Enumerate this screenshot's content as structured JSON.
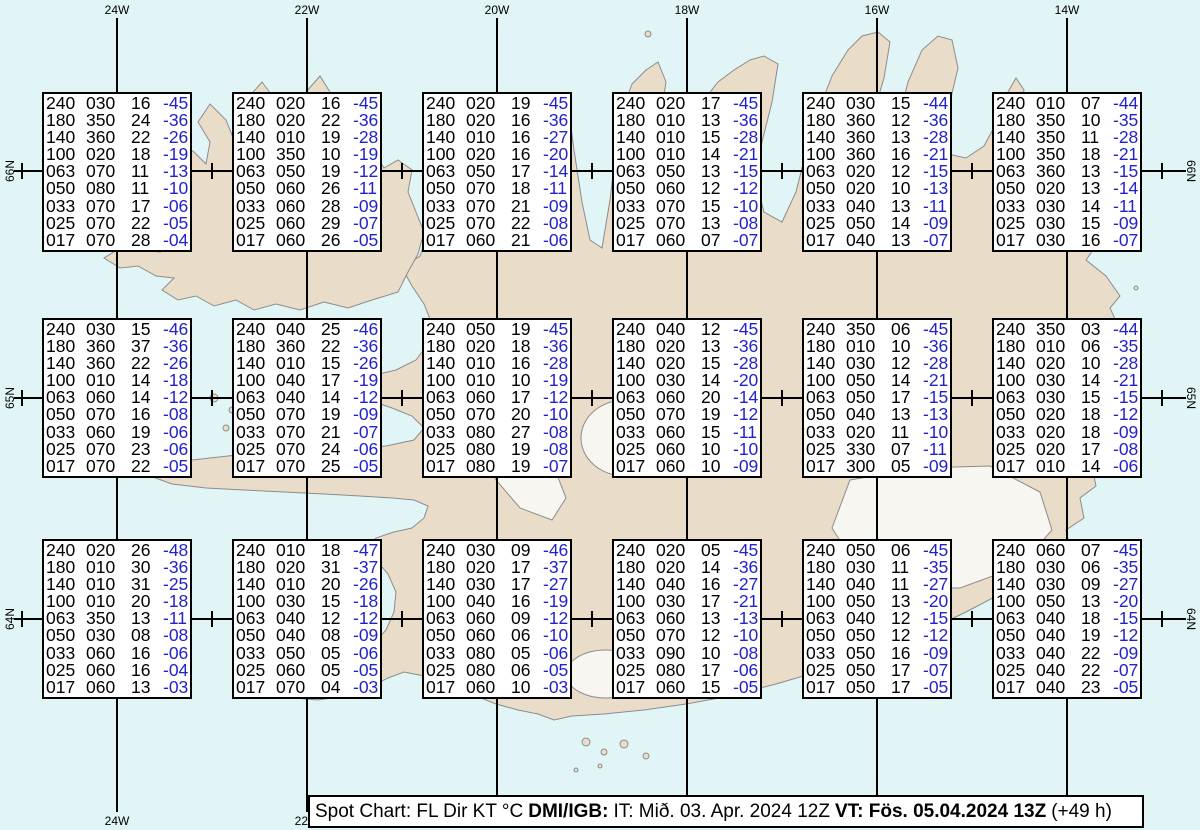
{
  "colors": {
    "ocean": "#E1F5F7",
    "land": "#E9DCC9",
    "glacier": "#F8F6F0",
    "coastline": "#8C8C8C",
    "grid_line": "#000000",
    "box_background": "#FFFFFF",
    "data_text": "#000000",
    "temperature_text": "#2222CC"
  },
  "map": {
    "top_longitude_labels": [
      "24W",
      "22W",
      "20W",
      "18W",
      "16W",
      "14W"
    ],
    "bottom_longitude_labels": [
      "24W",
      "22W"
    ],
    "left_latitude_labels": [
      "66N",
      "65N",
      "64N"
    ],
    "right_latitude_labels": [
      "66N",
      "65N",
      "64N"
    ]
  },
  "caption": {
    "title": "Spot Chart: FL Dir KT °C",
    "source": "DMI/IGB:",
    "issued": "IT: Mið. 03. Apr. 2024 12Z",
    "valid": "VT: Fös. 05.04.2024 13Z",
    "lead": "(+49 h)"
  },
  "chart_data": {
    "type": "table",
    "title": "Spot Chart: FL Dir KT °C",
    "columns": [
      "FL",
      "Dir",
      "KT",
      "°C"
    ],
    "stations": [
      {
        "lat": "66N",
        "lon": "24W",
        "values": [
          [
            "240",
            "030",
            "16",
            "-45"
          ],
          [
            "180",
            "350",
            "24",
            "-36"
          ],
          [
            "140",
            "360",
            "22",
            "-26"
          ],
          [
            "100",
            "020",
            "18",
            "-19"
          ],
          [
            "063",
            "070",
            "11",
            "-13"
          ],
          [
            "050",
            "080",
            "11",
            "-10"
          ],
          [
            "033",
            "070",
            "17",
            "-06"
          ],
          [
            "025",
            "070",
            "22",
            "-05"
          ],
          [
            "017",
            "070",
            "28",
            "-04"
          ]
        ]
      },
      {
        "lat": "66N",
        "lon": "22W",
        "values": [
          [
            "240",
            "020",
            "16",
            "-45"
          ],
          [
            "180",
            "020",
            "22",
            "-36"
          ],
          [
            "140",
            "010",
            "19",
            "-28"
          ],
          [
            "100",
            "350",
            "10",
            "-19"
          ],
          [
            "063",
            "050",
            "19",
            "-12"
          ],
          [
            "050",
            "060",
            "26",
            "-11"
          ],
          [
            "033",
            "060",
            "28",
            "-09"
          ],
          [
            "025",
            "060",
            "29",
            "-07"
          ],
          [
            "017",
            "060",
            "26",
            "-05"
          ]
        ]
      },
      {
        "lat": "66N",
        "lon": "20W",
        "values": [
          [
            "240",
            "020",
            "19",
            "-45"
          ],
          [
            "180",
            "020",
            "16",
            "-36"
          ],
          [
            "140",
            "010",
            "16",
            "-27"
          ],
          [
            "100",
            "020",
            "16",
            "-20"
          ],
          [
            "063",
            "050",
            "17",
            "-14"
          ],
          [
            "050",
            "070",
            "18",
            "-11"
          ],
          [
            "033",
            "070",
            "21",
            "-09"
          ],
          [
            "025",
            "070",
            "22",
            "-08"
          ],
          [
            "017",
            "060",
            "21",
            "-06"
          ]
        ]
      },
      {
        "lat": "66N",
        "lon": "18W",
        "values": [
          [
            "240",
            "020",
            "17",
            "-45"
          ],
          [
            "180",
            "010",
            "13",
            "-36"
          ],
          [
            "140",
            "010",
            "15",
            "-28"
          ],
          [
            "100",
            "010",
            "14",
            "-21"
          ],
          [
            "063",
            "050",
            "13",
            "-15"
          ],
          [
            "050",
            "060",
            "12",
            "-12"
          ],
          [
            "033",
            "070",
            "15",
            "-10"
          ],
          [
            "025",
            "070",
            "13",
            "-08"
          ],
          [
            "017",
            "060",
            "07",
            "-07"
          ]
        ]
      },
      {
        "lat": "66N",
        "lon": "16W",
        "values": [
          [
            "240",
            "030",
            "15",
            "-44"
          ],
          [
            "180",
            "360",
            "12",
            "-36"
          ],
          [
            "140",
            "360",
            "13",
            "-28"
          ],
          [
            "100",
            "360",
            "16",
            "-21"
          ],
          [
            "063",
            "020",
            "12",
            "-15"
          ],
          [
            "050",
            "020",
            "10",
            "-13"
          ],
          [
            "033",
            "040",
            "13",
            "-11"
          ],
          [
            "025",
            "050",
            "14",
            "-09"
          ],
          [
            "017",
            "040",
            "13",
            "-07"
          ]
        ]
      },
      {
        "lat": "66N",
        "lon": "14W",
        "values": [
          [
            "240",
            "010",
            "07",
            "-44"
          ],
          [
            "180",
            "350",
            "10",
            "-35"
          ],
          [
            "140",
            "350",
            "11",
            "-28"
          ],
          [
            "100",
            "350",
            "18",
            "-21"
          ],
          [
            "063",
            "360",
            "13",
            "-15"
          ],
          [
            "050",
            "020",
            "13",
            "-14"
          ],
          [
            "033",
            "030",
            "14",
            "-11"
          ],
          [
            "025",
            "030",
            "15",
            "-09"
          ],
          [
            "017",
            "030",
            "16",
            "-07"
          ]
        ]
      },
      {
        "lat": "65N",
        "lon": "24W",
        "values": [
          [
            "240",
            "030",
            "15",
            "-46"
          ],
          [
            "180",
            "360",
            "37",
            "-36"
          ],
          [
            "140",
            "360",
            "22",
            "-26"
          ],
          [
            "100",
            "010",
            "14",
            "-18"
          ],
          [
            "063",
            "060",
            "14",
            "-12"
          ],
          [
            "050",
            "070",
            "16",
            "-08"
          ],
          [
            "033",
            "060",
            "19",
            "-06"
          ],
          [
            "025",
            "070",
            "23",
            "-06"
          ],
          [
            "017",
            "070",
            "22",
            "-05"
          ]
        ]
      },
      {
        "lat": "65N",
        "lon": "22W",
        "values": [
          [
            "240",
            "040",
            "25",
            "-46"
          ],
          [
            "180",
            "360",
            "22",
            "-36"
          ],
          [
            "140",
            "010",
            "15",
            "-26"
          ],
          [
            "100",
            "040",
            "17",
            "-19"
          ],
          [
            "063",
            "040",
            "14",
            "-12"
          ],
          [
            "050",
            "070",
            "19",
            "-09"
          ],
          [
            "033",
            "070",
            "21",
            "-07"
          ],
          [
            "025",
            "070",
            "24",
            "-06"
          ],
          [
            "017",
            "070",
            "25",
            "-05"
          ]
        ]
      },
      {
        "lat": "65N",
        "lon": "20W",
        "values": [
          [
            "240",
            "050",
            "19",
            "-45"
          ],
          [
            "180",
            "020",
            "18",
            "-36"
          ],
          [
            "140",
            "010",
            "16",
            "-28"
          ],
          [
            "100",
            "010",
            "10",
            "-19"
          ],
          [
            "063",
            "060",
            "17",
            "-12"
          ],
          [
            "050",
            "070",
            "20",
            "-10"
          ],
          [
            "033",
            "080",
            "27",
            "-08"
          ],
          [
            "025",
            "080",
            "19",
            "-08"
          ],
          [
            "017",
            "080",
            "19",
            "-07"
          ]
        ]
      },
      {
        "lat": "65N",
        "lon": "18W",
        "values": [
          [
            "240",
            "040",
            "12",
            "-45"
          ],
          [
            "180",
            "020",
            "13",
            "-36"
          ],
          [
            "140",
            "020",
            "15",
            "-28"
          ],
          [
            "100",
            "030",
            "14",
            "-20"
          ],
          [
            "063",
            "060",
            "20",
            "-14"
          ],
          [
            "050",
            "070",
            "19",
            "-12"
          ],
          [
            "033",
            "060",
            "15",
            "-11"
          ],
          [
            "025",
            "060",
            "10",
            "-10"
          ],
          [
            "017",
            "060",
            "10",
            "-09"
          ]
        ]
      },
      {
        "lat": "65N",
        "lon": "16W",
        "values": [
          [
            "240",
            "350",
            "06",
            "-45"
          ],
          [
            "180",
            "010",
            "10",
            "-36"
          ],
          [
            "140",
            "030",
            "12",
            "-28"
          ],
          [
            "100",
            "050",
            "14",
            "-21"
          ],
          [
            "063",
            "050",
            "17",
            "-15"
          ],
          [
            "050",
            "040",
            "13",
            "-13"
          ],
          [
            "033",
            "020",
            "11",
            "-10"
          ],
          [
            "025",
            "330",
            "07",
            "-11"
          ],
          [
            "017",
            "300",
            "05",
            "-09"
          ]
        ]
      },
      {
        "lat": "65N",
        "lon": "14W",
        "values": [
          [
            "240",
            "350",
            "03",
            "-44"
          ],
          [
            "180",
            "010",
            "06",
            "-35"
          ],
          [
            "140",
            "020",
            "10",
            "-28"
          ],
          [
            "100",
            "030",
            "14",
            "-21"
          ],
          [
            "063",
            "030",
            "15",
            "-15"
          ],
          [
            "050",
            "020",
            "18",
            "-12"
          ],
          [
            "033",
            "020",
            "18",
            "-09"
          ],
          [
            "025",
            "020",
            "17",
            "-08"
          ],
          [
            "017",
            "010",
            "14",
            "-06"
          ]
        ]
      },
      {
        "lat": "64N",
        "lon": "24W",
        "values": [
          [
            "240",
            "020",
            "26",
            "-48"
          ],
          [
            "180",
            "010",
            "30",
            "-36"
          ],
          [
            "140",
            "010",
            "31",
            "-25"
          ],
          [
            "100",
            "010",
            "20",
            "-18"
          ],
          [
            "063",
            "350",
            "13",
            "-11"
          ],
          [
            "050",
            "030",
            "08",
            "-08"
          ],
          [
            "033",
            "060",
            "16",
            "-06"
          ],
          [
            "025",
            "060",
            "16",
            "-04"
          ],
          [
            "017",
            "060",
            "13",
            "-03"
          ]
        ]
      },
      {
        "lat": "64N",
        "lon": "22W",
        "values": [
          [
            "240",
            "010",
            "18",
            "-47"
          ],
          [
            "180",
            "020",
            "31",
            "-37"
          ],
          [
            "140",
            "010",
            "20",
            "-26"
          ],
          [
            "100",
            "030",
            "15",
            "-18"
          ],
          [
            "063",
            "040",
            "12",
            "-12"
          ],
          [
            "050",
            "040",
            "08",
            "-09"
          ],
          [
            "033",
            "050",
            "05",
            "-06"
          ],
          [
            "025",
            "060",
            "05",
            "-05"
          ],
          [
            "017",
            "070",
            "04",
            "-03"
          ]
        ]
      },
      {
        "lat": "64N",
        "lon": "20W",
        "values": [
          [
            "240",
            "030",
            "09",
            "-46"
          ],
          [
            "180",
            "020",
            "17",
            "-37"
          ],
          [
            "140",
            "030",
            "17",
            "-27"
          ],
          [
            "100",
            "040",
            "16",
            "-19"
          ],
          [
            "063",
            "060",
            "09",
            "-12"
          ],
          [
            "050",
            "060",
            "06",
            "-10"
          ],
          [
            "033",
            "080",
            "05",
            "-06"
          ],
          [
            "025",
            "080",
            "06",
            "-05"
          ],
          [
            "017",
            "060",
            "10",
            "-03"
          ]
        ]
      },
      {
        "lat": "64N",
        "lon": "18W",
        "values": [
          [
            "240",
            "020",
            "05",
            "-45"
          ],
          [
            "180",
            "020",
            "14",
            "-36"
          ],
          [
            "140",
            "040",
            "16",
            "-27"
          ],
          [
            "100",
            "030",
            "17",
            "-21"
          ],
          [
            "063",
            "060",
            "13",
            "-13"
          ],
          [
            "050",
            "070",
            "12",
            "-10"
          ],
          [
            "033",
            "090",
            "10",
            "-08"
          ],
          [
            "025",
            "080",
            "17",
            "-06"
          ],
          [
            "017",
            "060",
            "15",
            "-05"
          ]
        ]
      },
      {
        "lat": "64N",
        "lon": "16W",
        "values": [
          [
            "240",
            "050",
            "06",
            "-45"
          ],
          [
            "180",
            "030",
            "11",
            "-35"
          ],
          [
            "140",
            "040",
            "11",
            "-27"
          ],
          [
            "100",
            "050",
            "13",
            "-20"
          ],
          [
            "063",
            "040",
            "12",
            "-15"
          ],
          [
            "050",
            "050",
            "12",
            "-12"
          ],
          [
            "033",
            "050",
            "16",
            "-09"
          ],
          [
            "025",
            "050",
            "17",
            "-07"
          ],
          [
            "017",
            "050",
            "17",
            "-05"
          ]
        ]
      },
      {
        "lat": "64N",
        "lon": "14W",
        "values": [
          [
            "240",
            "060",
            "07",
            "-45"
          ],
          [
            "180",
            "030",
            "06",
            "-35"
          ],
          [
            "140",
            "030",
            "09",
            "-27"
          ],
          [
            "100",
            "050",
            "13",
            "-20"
          ],
          [
            "063",
            "040",
            "18",
            "-15"
          ],
          [
            "050",
            "040",
            "19",
            "-12"
          ],
          [
            "033",
            "040",
            "22",
            "-09"
          ],
          [
            "025",
            "040",
            "22",
            "-07"
          ],
          [
            "017",
            "040",
            "23",
            "-05"
          ]
        ]
      }
    ]
  }
}
